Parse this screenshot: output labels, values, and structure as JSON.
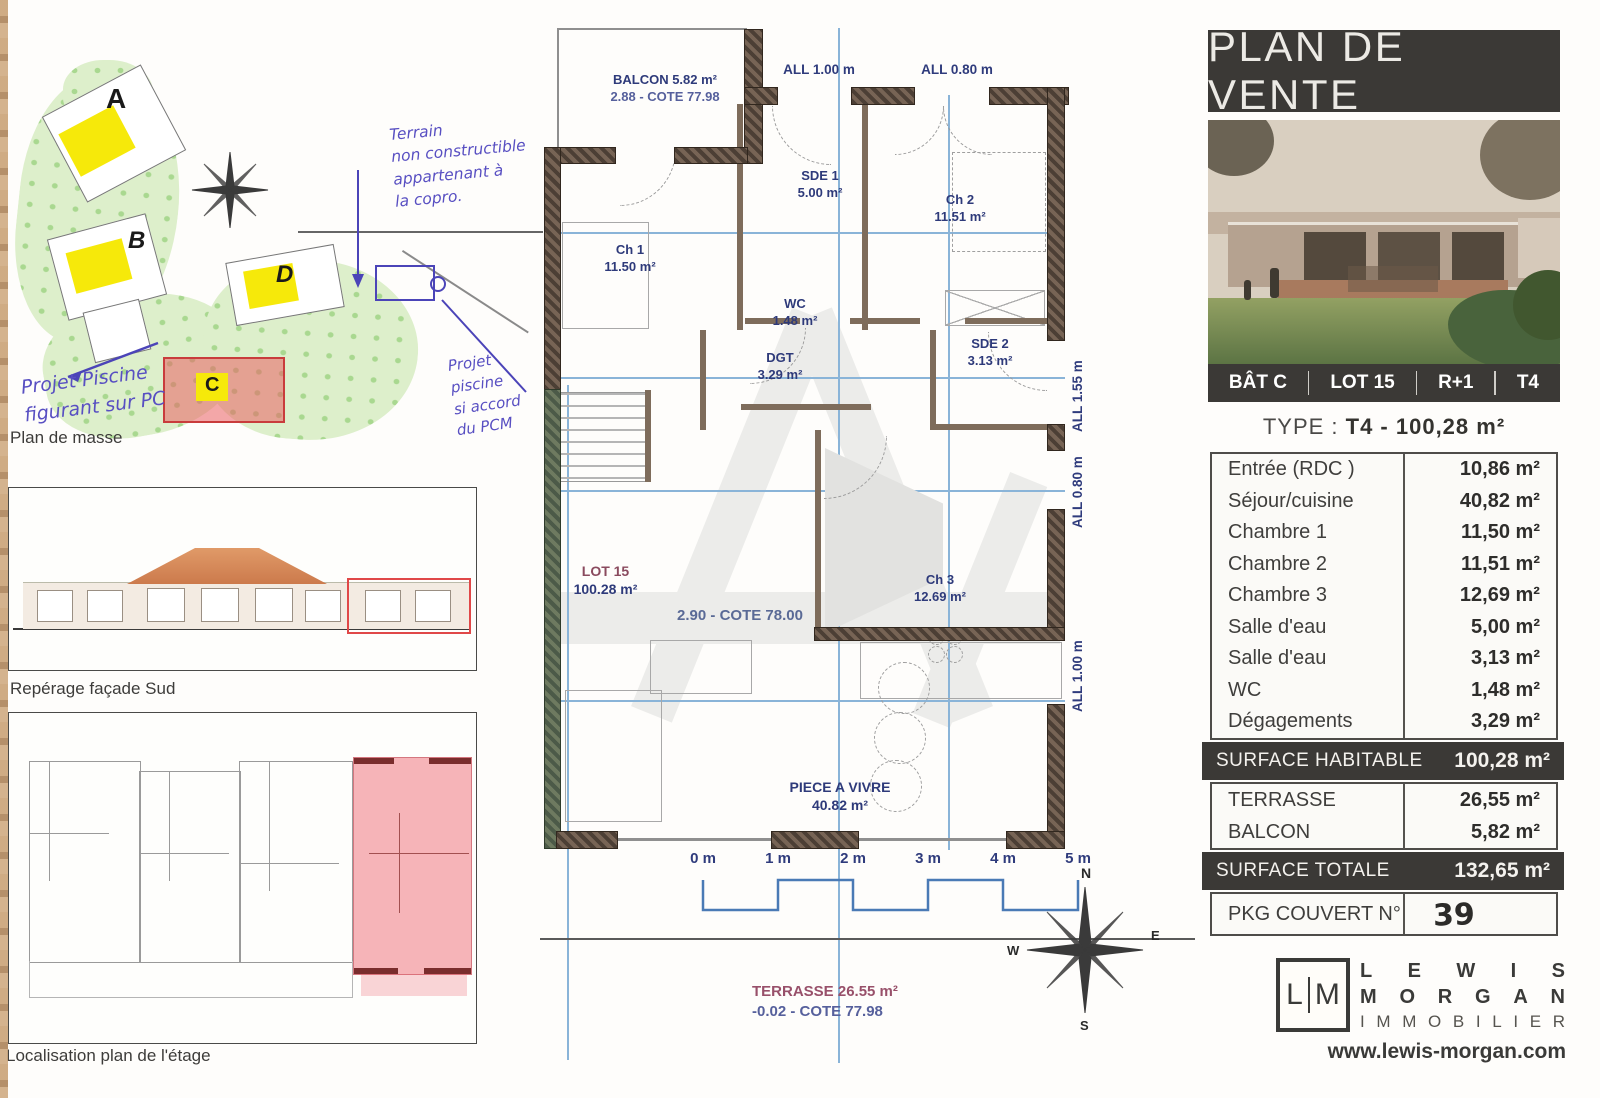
{
  "left": {
    "site": {
      "label": "Plan de masse",
      "buildings": {
        "a": "A",
        "b": "B",
        "c": "C",
        "d": "D"
      },
      "note_top": {
        "l1": "Terrain",
        "l2": "non constructible",
        "l3": "appartenant à",
        "l4": "la copro."
      },
      "note_mid": {
        "l1": "Projet",
        "l2": "piscine",
        "l3": "si accord",
        "l4": "du PCM"
      },
      "note_bottom": {
        "l1": "Projet Piscine",
        "l2": "figurant sur PC"
      }
    },
    "facade": {
      "label": "Repérage façade Sud"
    },
    "localisation": {
      "label": "Localisation plan de l'étage"
    }
  },
  "plan": {
    "balcon_l1": "BALCON 5.82 m²",
    "balcon_l2": "2.88 - COTE 77.98",
    "all_top_left": "ALL 1.00 m",
    "all_top_right": "ALL 0.80 m",
    "all_right_top": "ALL 1.55 m",
    "all_right_mid": "ALL 0.80 m",
    "all_right_bottom": "ALL 1.00 m",
    "rooms": [
      {
        "name": "SDE 1",
        "area": "5.00 m²"
      },
      {
        "name": "Ch 1",
        "area": "11.50 m²"
      },
      {
        "name": "Ch 2",
        "area": "11.51 m²"
      },
      {
        "name": "WC",
        "area": "1.48 m²"
      },
      {
        "name": "DGT",
        "area": "3.29 m²"
      },
      {
        "name": "SDE 2",
        "area": "3.13 m²"
      },
      {
        "name": "Ch 3",
        "area": "12.69 m²"
      },
      {
        "name": "PIECE A VIVRE",
        "area": "40.82 m²"
      }
    ],
    "lot_name": "LOT 15",
    "lot_area": "100.28 m²",
    "cote_main": "2.90 - COTE 78.00",
    "terrasse_l1": "TERRASSE 26.55 m²",
    "terrasse_l2": "-0.02 - COTE 77.98",
    "scale_ticks": [
      "0 m",
      "1 m",
      "2 m",
      "3 m",
      "4 m",
      "5 m"
    ],
    "compass": {
      "n": "N",
      "e": "E",
      "s": "S",
      "w": "W"
    }
  },
  "panel": {
    "title": "PLAN DE VENTE",
    "info_items": [
      "BÂT C",
      "LOT 15",
      "R+1",
      "T4"
    ],
    "type_label": "TYPE :",
    "type_value": "T4 - 100,28 m²",
    "rows": [
      {
        "label": "Entrée (RDC )",
        "value": "10,86 m²"
      },
      {
        "label": "Séjour/cuisine",
        "value": "40,82 m²"
      },
      {
        "label": "Chambre 1",
        "value": "11,50 m²"
      },
      {
        "label": "Chambre 2",
        "value": "11,51 m²"
      },
      {
        "label": "Chambre 3",
        "value": "12,69 m²"
      },
      {
        "label": "Salle d'eau",
        "value": "5,00 m²"
      },
      {
        "label": "Salle d'eau",
        "value": "3,13 m²"
      },
      {
        "label": "WC",
        "value": "1,48 m²"
      },
      {
        "label": "Dégagements",
        "value": "3,29 m²"
      }
    ],
    "surface_habitable": {
      "label": "SURFACE HABITABLE",
      "value": "100,28 m²"
    },
    "annex": [
      {
        "label": "TERRASSE",
        "value": "26,55 m²"
      },
      {
        "label": "BALCON",
        "value": "5,82 m²"
      }
    ],
    "surface_totale": {
      "label": "SURFACE TOTALE",
      "value": "132,65 m²"
    },
    "pkg_label": "PKG COUVERT N°",
    "pkg_value": "39",
    "logo": {
      "mono_l": "L",
      "mono_m": "M",
      "line1": "LEWIS",
      "line2": "MORGAN",
      "line3": "IMMOBILIER",
      "website": "www.lewis-morgan.com"
    }
  }
}
